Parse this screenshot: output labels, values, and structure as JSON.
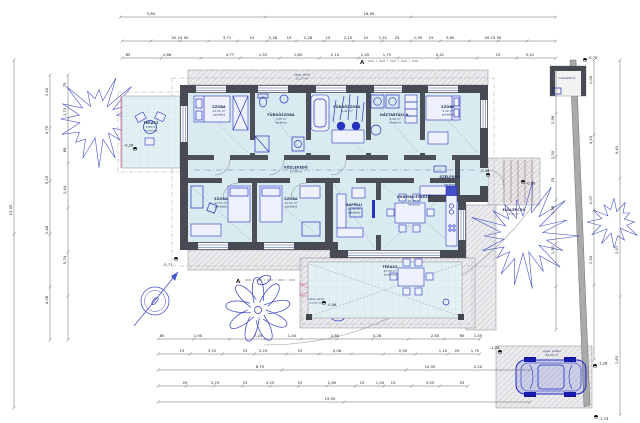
{
  "drawing": {
    "type": "architectural ground-floor plan with site layout",
    "language": "Hungarian",
    "section_marker": "A",
    "overall_width": "18,95",
    "overall_height": "10,55"
  },
  "colors": {
    "accent_blue": "#2633c0",
    "room_fill": "#d9ebf0",
    "terrace_fill": "#e3f1f4",
    "wall": "#42454d",
    "pavement": "#ebebee",
    "red_accent": "#cc4466",
    "fence": "#aaaaab"
  },
  "icons": {
    "north_arrow": "north-arrow",
    "tree": "deciduous-tree",
    "swirl_tree": "ornamental-tree",
    "shrub": "shrub",
    "car": "car-top-view",
    "level_marker": "level-elevation-marker"
  },
  "rooms": [
    {
      "id": "terasz-left",
      "name": "TERASZ",
      "area": "7,80 m²",
      "finish": "burkolva"
    },
    {
      "id": "szoba-1",
      "name": "SZOBA",
      "area": "12,05 m²",
      "finish": "parketta"
    },
    {
      "id": "furdoszoba-1",
      "name": "FÜRDŐSZOBA",
      "area": "7,05 m²",
      "finish": "kerámia"
    },
    {
      "id": "furdoszoba-2",
      "name": "FÜRDŐSZOBA",
      "area": "6,41 m²",
      "finish": "kerámia"
    },
    {
      "id": "haztartasi",
      "name": "HÁZTARTÁSI H.",
      "area": "4,92 m²",
      "finish": "kerámia"
    },
    {
      "id": "szoba-2",
      "name": "SZOBA",
      "area": "9,30 m²",
      "finish": "parketta"
    },
    {
      "id": "kozlekedo",
      "name": "KÖZLEKEDŐ",
      "area": "13,40 m²",
      "finish": "kerámia"
    },
    {
      "id": "szoba-3",
      "name": "SZOBA",
      "area": "12,53 m²",
      "finish": "parketta"
    },
    {
      "id": "szoba-4",
      "name": "SZOBA",
      "area": "12,53 m²",
      "finish": "parketta"
    },
    {
      "id": "nappali",
      "name": "NAPPALI",
      "area": "21,35 m²",
      "finish": "parketta"
    },
    {
      "id": "konyha-etkezo",
      "name": "KONYHA-ÉTKEZŐ",
      "area": "15,75 m²",
      "finish": "kerámia"
    },
    {
      "id": "szelfogo",
      "name": "SZÉLFOGÓ",
      "area": "1,91 m²",
      "finish": "kerámia"
    },
    {
      "id": "elolepcso",
      "name": "ELŐLÉPCSŐ",
      "area": "5,21 m²",
      "finish": "kerámia"
    },
    {
      "id": "terasz-back",
      "name": "TERASZ",
      "area": "32,50 m²",
      "finish": "burkolva"
    },
    {
      "id": "hatso-jarda",
      "name": "hátsó járda",
      "area": "17,57 m²",
      "finish": ""
    },
    {
      "id": "szeg-jarda",
      "name": "szeg. járda",
      "area": "11,27 m²",
      "finish": ""
    },
    {
      "id": "gepkocsi-beallo",
      "name": "gépk. beálló",
      "area": "20,56 m²",
      "finish": ""
    },
    {
      "id": "hulladektarolo",
      "name": "hulladéktároló",
      "area": "",
      "finish": ""
    }
  ],
  "dims": {
    "top1": [
      "3,60",
      "18,95"
    ],
    "top2": [
      "50 15 50",
      "3,71",
      "15",
      "2,28",
      "15",
      "2,28",
      "15",
      "2,15",
      "10",
      "1,51",
      "25",
      "1,95",
      "15",
      "3,60",
      "50 15 50"
    ],
    "top3": [
      "85",
      "2,86",
      "4,77",
      "1,53",
      "1,85",
      "2,10",
      "1,45",
      "1,75",
      "5,41",
      "15",
      "5,41"
    ],
    "left1": [
      "10,55"
    ],
    "left2": [
      "1,40",
      "3,75",
      "5,25",
      "1,48",
      "4,08"
    ],
    "left3": [
      "75",
      "1,73",
      "68",
      "1,44",
      "5,74"
    ],
    "right1": [
      "1,00",
      "1,98",
      "1,50",
      "25",
      "1,98",
      "1,50"
    ],
    "right2": [
      "1,00",
      "4,15",
      "2,07",
      "1,50"
    ],
    "right3": [
      "4,40",
      "2,97",
      "1,63"
    ],
    "bottom1": [
      "85",
      "1,90",
      "7,20",
      "1,40",
      "2,85",
      "4,28",
      "2,85",
      "65",
      "1,45"
    ],
    "bottom2": [
      "15",
      "3,25",
      "15",
      "3,25",
      "15",
      "5,06",
      "2,50",
      "1,10",
      "25",
      "1,70"
    ],
    "bottom3": [
      "6,75",
      "10,55",
      "2,20"
    ],
    "bottom4": [
      "25",
      "3,25",
      "15",
      "3,25",
      "15",
      "2,65",
      "15",
      "1,50",
      "15",
      "3,55",
      "25"
    ],
    "bottom5": [
      "15,55"
    ]
  },
  "levels": [
    "-0,26",
    "-0,71",
    "-0,56",
    "-0,36",
    "-0,90",
    "-0,75",
    "-1,24",
    "-1,28",
    "-1,73"
  ]
}
